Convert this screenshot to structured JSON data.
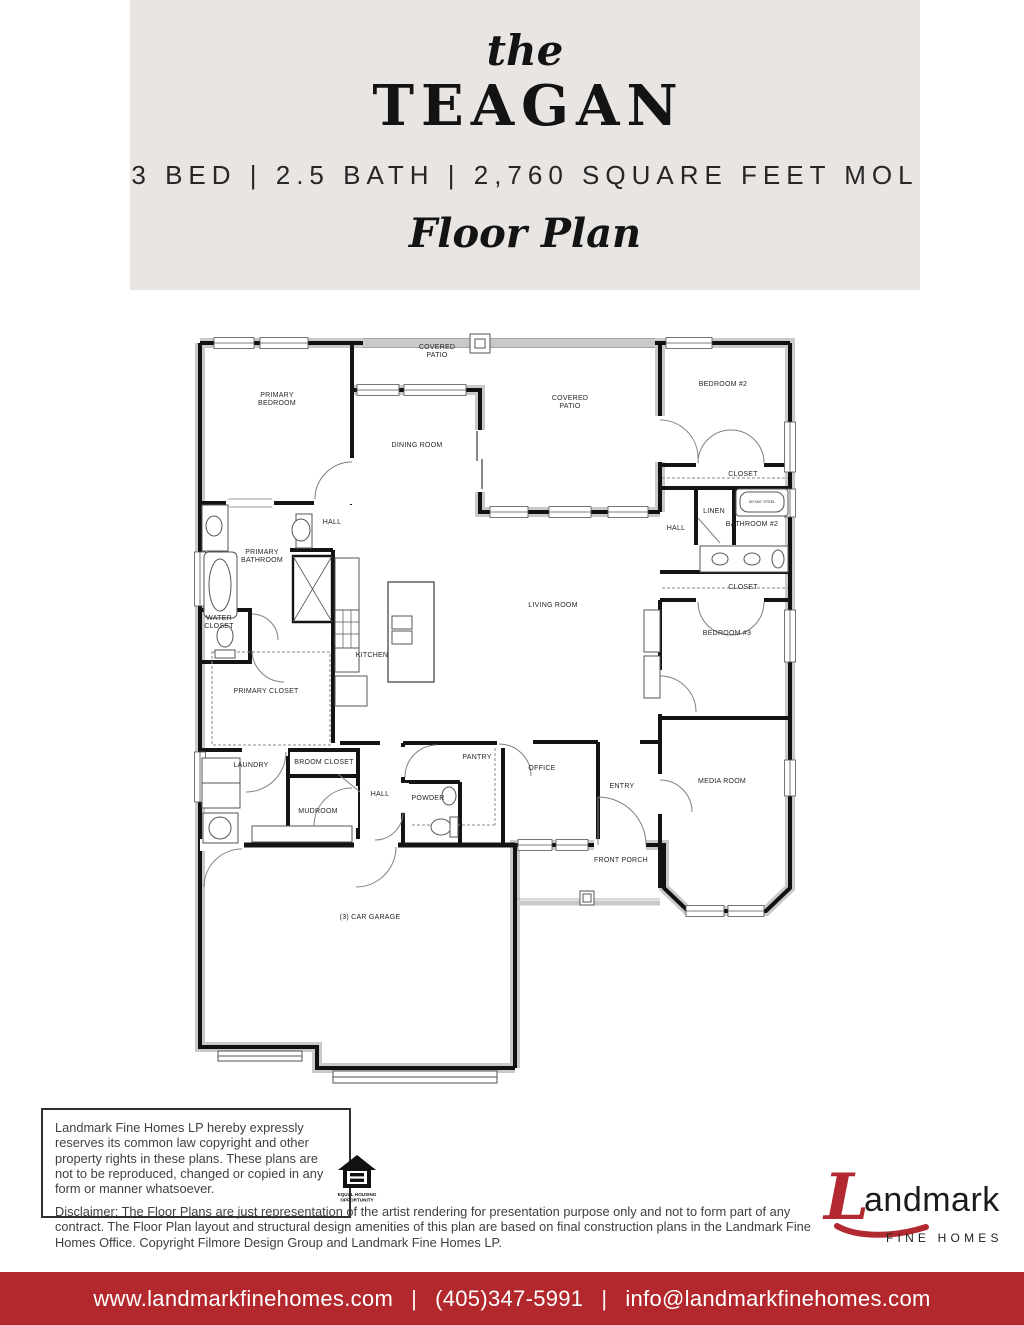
{
  "header": {
    "prefix": "the",
    "title": "TEAGAN",
    "specs": "3 BED | 2.5 BATH | 2,760 SQUARE FEET MOL",
    "subtitle": "Floor Plan"
  },
  "floor_plan": {
    "rooms": [
      {
        "label": "COVERED PATIO"
      },
      {
        "label": "PRIMARY BEDROOM"
      },
      {
        "label": "BEDROOM #2"
      },
      {
        "label": "COVERED PATIO"
      },
      {
        "label": "DINING ROOM"
      },
      {
        "label": "CLOSET"
      },
      {
        "label": "LINEN"
      },
      {
        "label": "30\"X60\" STEEL"
      },
      {
        "label": "BATHROOM #2"
      },
      {
        "label": "HALL"
      },
      {
        "label": "HALL"
      },
      {
        "label": "PRIMARY BATHROOM"
      },
      {
        "label": "LIVING ROOM"
      },
      {
        "label": "WATER CLOSET"
      },
      {
        "label": "CLOSET"
      },
      {
        "label": "BEDROOM #3"
      },
      {
        "label": "KITCHEN"
      },
      {
        "label": "PRIMARY CLOSET"
      },
      {
        "label": "LAUNDRY"
      },
      {
        "label": "BROOM CLOSET"
      },
      {
        "label": "PANTRY"
      },
      {
        "label": "OFFICE"
      },
      {
        "label": "ENTRY"
      },
      {
        "label": "MEDIA ROOM"
      },
      {
        "label": "HALL"
      },
      {
        "label": "POWDER"
      },
      {
        "label": "MUDROOM"
      },
      {
        "label": "FRONT PORCH"
      },
      {
        "label": "(3) CAR GARAGE"
      }
    ]
  },
  "legal": {
    "copyright_notice": "Landmark Fine Homes LP hereby expressly reserves its common law copyright and other property rights in these plans. These plans are not to be reproduced, changed or copied in any form or manner whatsoever.",
    "disclaimer": "Disclaimer: The Floor Plans are just representation of the artist rendering for presentation purpose only and not to form part of any contract. The Floor Plan layout and structural design amenities of this plan are based on final construction plans in the Landmark Fine Homes Office. Copyright Filmore Design Group and Landmark Fine Homes LP.",
    "eho_line1": "EQUAL HOUSING",
    "eho_line2": "OPPORTUNITY"
  },
  "logo": {
    "brand_l": "L",
    "brand_rest": "andmark",
    "brand_sub": "FINE HOMES"
  },
  "footer": {
    "website": "www.landmarkfinehomes.com",
    "separator": "|",
    "phone": "(405)347-5991",
    "email": "info@landmarkfinehomes.com"
  },
  "colors": {
    "accent_red": "#b2292f",
    "header_bg": "#e9e5e2",
    "ink": "#131313"
  }
}
